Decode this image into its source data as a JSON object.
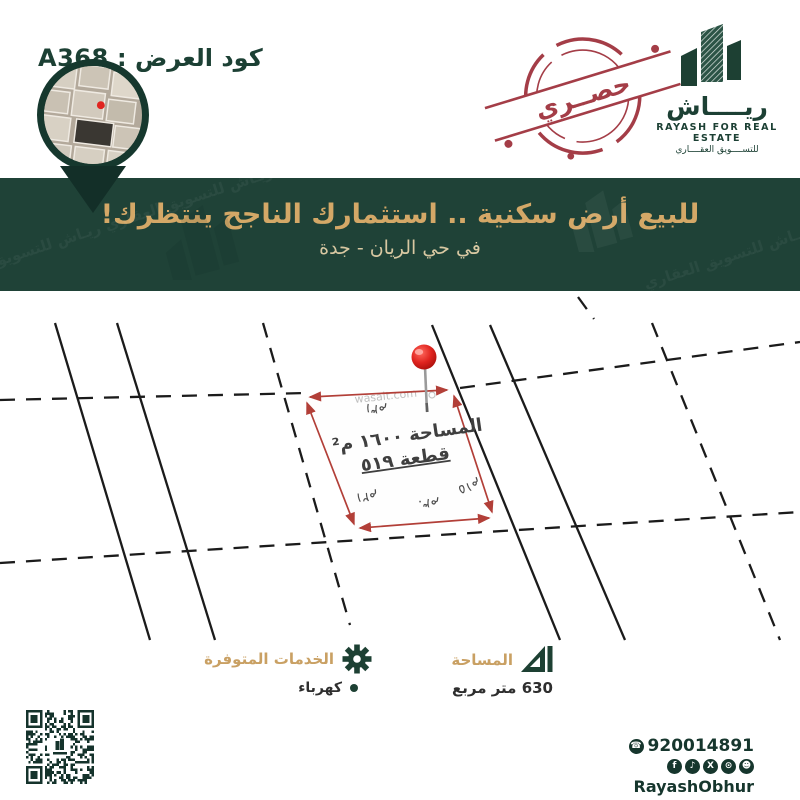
{
  "colors": {
    "banner_green": "#1f4237",
    "dark_green": "#142f27",
    "ink_green": "#1c4034",
    "gold": "#cfa465",
    "cream": "#d8c8a2",
    "stamp_maroon": "#a43d47",
    "arrow_red": "#b23f38",
    "pin_red": "#e0241f"
  },
  "header": {
    "offer_code": "كود العرض : A368"
  },
  "brand": {
    "name_ar": "ريــــاش",
    "name_en": "RAYASH FOR REAL ESTATE",
    "tagline_ar": "للتســــويق العقــــاري",
    "stamp_text": "حصــري"
  },
  "banner": {
    "title": "للبيع أرض سكنية .. استثمارك الناجح ينتظرك!",
    "subtitle": "في حي الريان - جدة"
  },
  "plot_map": {
    "watermark": "wasalt.com",
    "area_text": "المساحة ١٦٠٠ م²",
    "plot_text": "قطعة ٥١٩",
    "dimensions": {
      "top": "٣١م",
      "right": "١٥م",
      "bottom": "٣٠م",
      "left": "٢١م"
    }
  },
  "details": {
    "area": {
      "label": "المساحة",
      "value": "630 متر مربع"
    },
    "services": {
      "label": "الخدمات المتوفرة",
      "items": [
        "كهرباء"
      ]
    }
  },
  "footer": {
    "phone": "920014891",
    "phone_icon_glyph": "☎",
    "handle": "RayashObhur",
    "social_icons": [
      {
        "name": "facebook",
        "glyph": "f"
      },
      {
        "name": "tiktok",
        "glyph": "♪"
      },
      {
        "name": "x-twitter",
        "glyph": "X"
      },
      {
        "name": "instagram",
        "glyph": "⊙"
      },
      {
        "name": "snapchat",
        "glyph": "☻"
      }
    ]
  }
}
